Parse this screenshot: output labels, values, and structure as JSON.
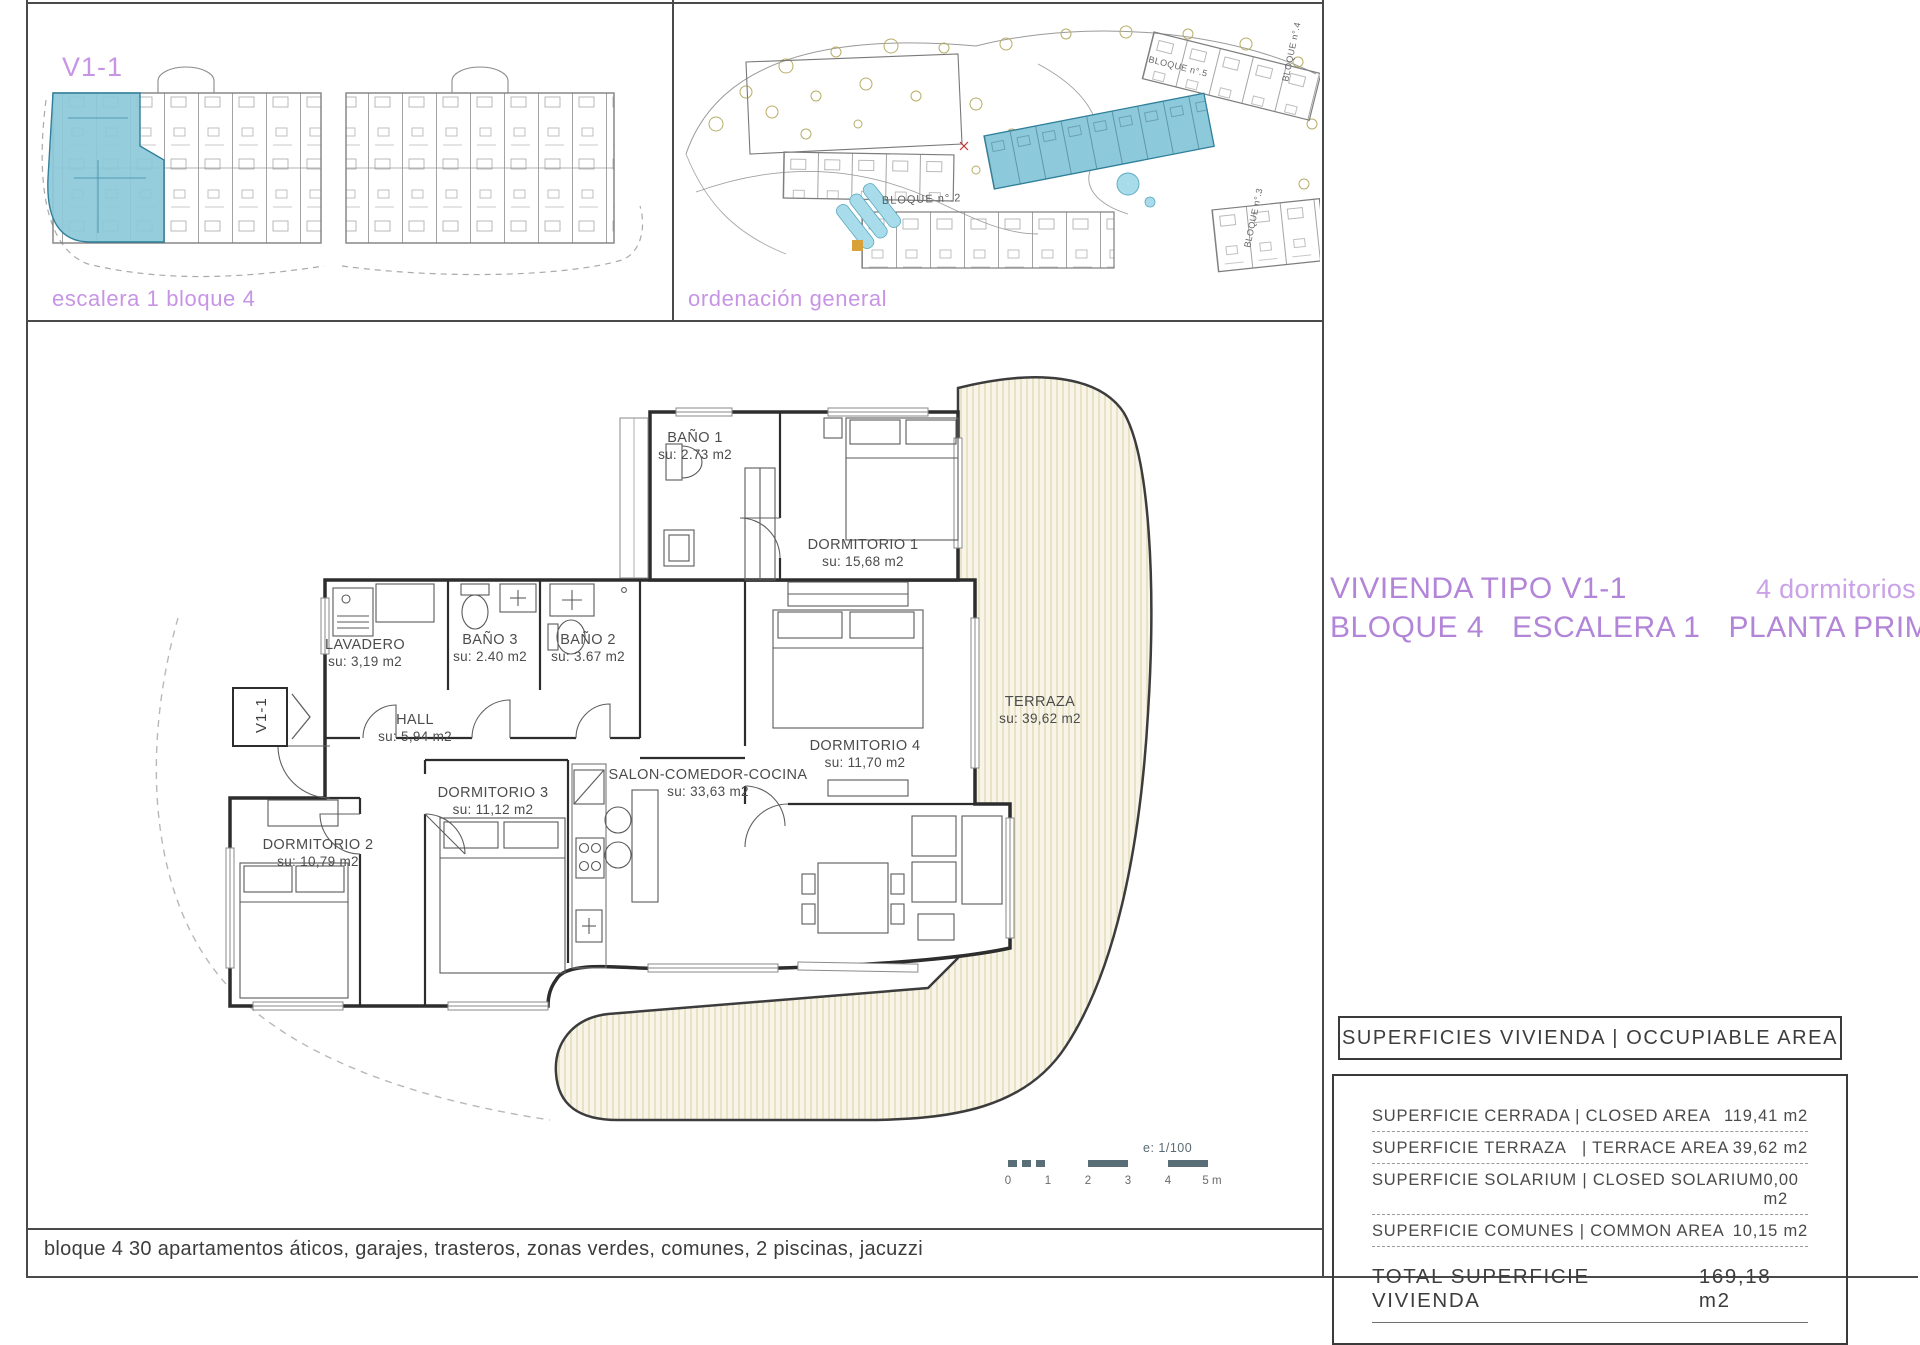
{
  "panel_block": {
    "label": "V1-1",
    "caption": "escalera 1 bloque 4"
  },
  "panel_site": {
    "caption": "ordenación general",
    "labels": {
      "b2": "BLOQUE n°.2",
      "b3": "BLOQUE n°.3",
      "b4": "BLOQUE n°.4",
      "b5": "BLOQUE n°.5"
    }
  },
  "title_block": {
    "name": "VIVIENDA TIPO V1-1",
    "bedrooms": "4 dormitorios",
    "bloque": "BLOQUE 4",
    "escalera": "ESCALERA 1",
    "planta": "PLANTA PRIMERA"
  },
  "floor_plan": {
    "entrance_tag": "V1-1",
    "rooms": [
      {
        "name": "BAÑO 1",
        "area": "su: 2.73 m2"
      },
      {
        "name": "DORMITORIO 1",
        "area": "su: 15,68 m2"
      },
      {
        "name": "LAVADERO",
        "area": "su: 3,19 m2"
      },
      {
        "name": "BAÑO 3",
        "area": "su: 2.40 m2"
      },
      {
        "name": "BAÑO 2",
        "area": "su: 3.67 m2"
      },
      {
        "name": "HALL",
        "area": "su: 5,94 m2"
      },
      {
        "name": "DORMITORIO 4",
        "area": "su: 11,70 m2"
      },
      {
        "name": "TERRAZA",
        "area": "su: 39,62 m2"
      },
      {
        "name": "DORMITORIO 3",
        "area": "su: 11,12 m2"
      },
      {
        "name": "DORMITORIO 2",
        "area": "su: 10,79 m2"
      },
      {
        "name": "SALON-COMEDOR-COCINA",
        "area": "su: 33,63 m2"
      }
    ]
  },
  "scale_bar": {
    "ratio": "e: 1/100",
    "ticks": [
      "0",
      "1",
      "2",
      "3",
      "4",
      "5 m"
    ]
  },
  "areas_table": {
    "header": "SUPERFICIES VIVIENDA | OCCUPIABLE AREA",
    "rows": [
      {
        "label": "SUPERFICIE CERRADA | CLOSED AREA",
        "value": "119,41 m2"
      },
      {
        "label": "SUPERFICIE TERRAZA   | TERRACE AREA",
        "value": "39,62 m2"
      },
      {
        "label": "SUPERFICIE SOLARIUM | CLOSED SOLARIUM",
        "value": "0,00 m2"
      },
      {
        "label": "SUPERFICIE COMUNES | COMMON AREA",
        "value": "10,15 m2"
      }
    ],
    "total": {
      "label": "TOTAL SUPERFICIE VIVIENDA",
      "value": "169,18 m2"
    }
  },
  "footer": {
    "text": "bloque 4 30 apartamentos áticos, garajes, trasteros, zonas verdes, comunes, 2 piscinas, jacuzzi"
  },
  "colors": {
    "accent_purple": "#b285d8",
    "highlight_blue": "#8cc9da",
    "terrace_cream": "#f8f5e8",
    "line_dark": "#3a3a3a"
  }
}
